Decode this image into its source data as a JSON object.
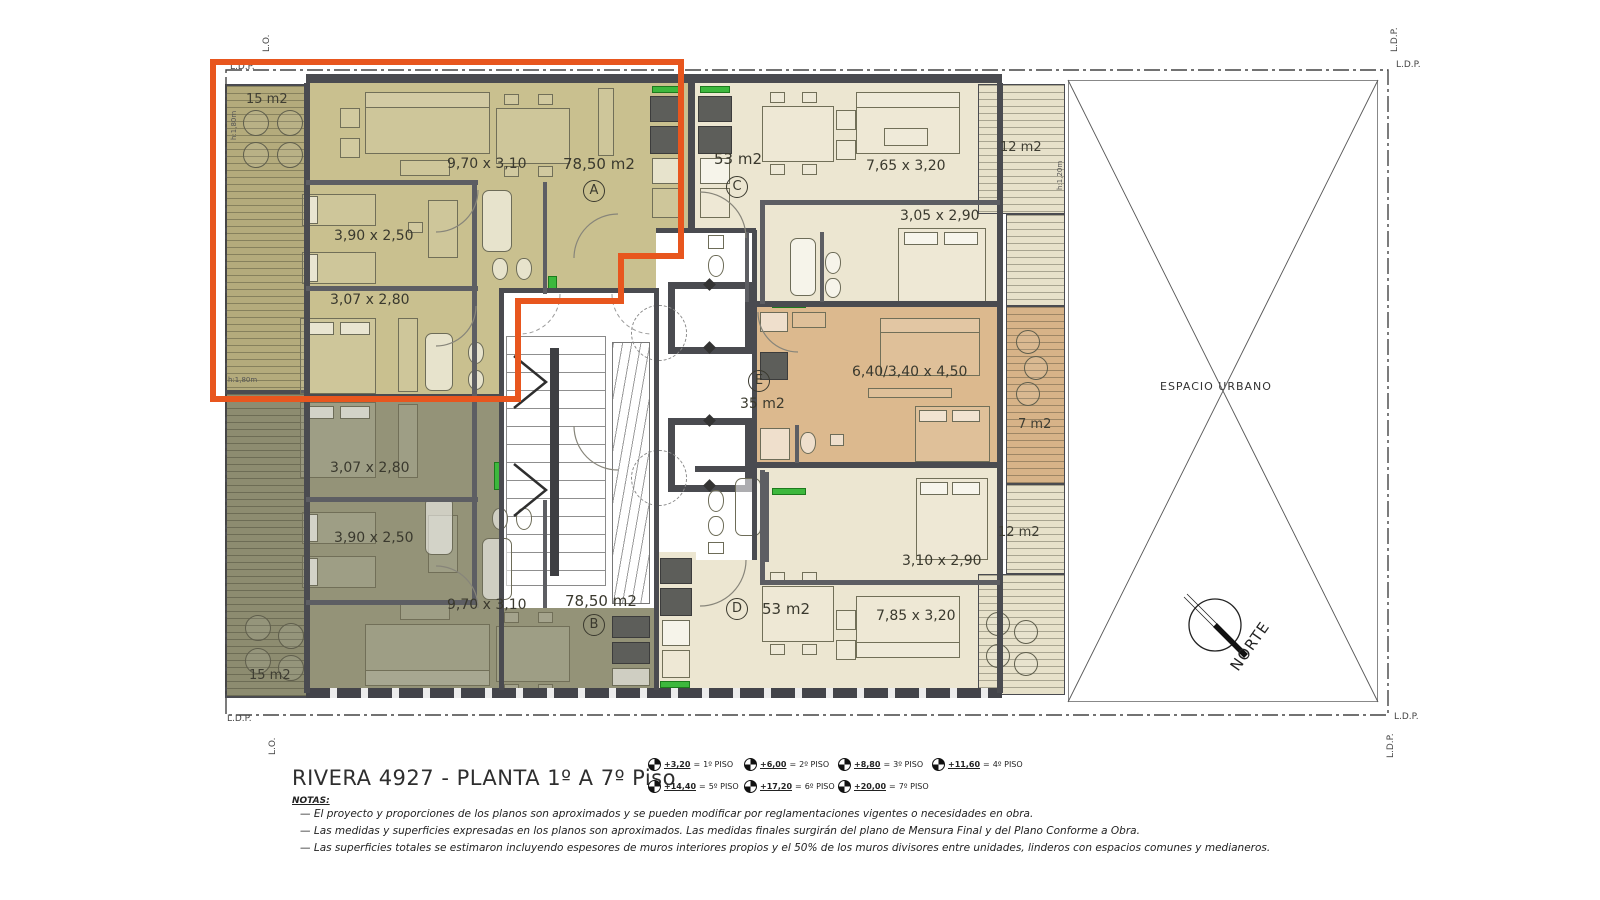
{
  "title_block": {
    "title": "RIVERA 4927  - PLANTA 1º A 7º Piso",
    "notas_label": "NOTAS:",
    "notes": [
      "—   El proyecto y proporciones de los planos son aproximados y se pueden modificar por reglamentaciones vigentes o necesidades en obra.",
      "—   Las medidas y superficies expresadas en los planos son aproximados. Las medidas finales surgirán del plano de Mensura Final y del Plano Conforme a Obra.",
      "—   Las superficies totales se estimaron incluyendo espesores de muros interiores propios y el 50% de los muros divisores entre unidades, linderos con espacios comunes y medianeros."
    ],
    "levels_eq": "=",
    "levels": [
      {
        "value": "+3,20",
        "floor": "1º PISO"
      },
      {
        "value": "+6,00",
        "floor": "2º PISO"
      },
      {
        "value": "+8,80",
        "floor": "3º PISO"
      },
      {
        "value": "+11,60",
        "floor": "4º PISO"
      },
      {
        "value": "+14,40",
        "floor": "5º PISO"
      },
      {
        "value": "+17,20",
        "floor": "6º PISO"
      },
      {
        "value": "+20,00",
        "floor": "7º PISO"
      }
    ]
  },
  "plan": {
    "espacio_urbano": "ESPACIO URBANO",
    "norte": "NORTE",
    "ldp": "L.D.P.",
    "lo": "L.O.",
    "units": {
      "a": {
        "letter": "A",
        "area": "78,50 m2",
        "living": "9,70 x 3,10",
        "bed1": "3,90 x 2,50",
        "bed2": "3,07 x 2,80",
        "balcony": "15 m2"
      },
      "b": {
        "letter": "B",
        "area": "78,50 m2",
        "living": "9,70 x 3,10",
        "bed1": "3,90 x 2,50",
        "bed2": "3,07 x 2,80",
        "balcony": "15 m2"
      },
      "c": {
        "letter": "C",
        "area": "53 m2",
        "living": "7,65 x 3,20",
        "bed": "3,05 x 2,90",
        "balcony": "12 m2"
      },
      "d": {
        "letter": "D",
        "area": "53 m2",
        "living": "7,85 x 3,20",
        "bed": "3,10 x 2,90",
        "balcony": "12 m2"
      },
      "e": {
        "letter": "E",
        "area": "35 m2",
        "dim": "6,40/3,40 x 4,50",
        "balcony": "7 m2"
      }
    },
    "small_labels": {
      "h180": "h:1,80m",
      "h120": "h:1,20m"
    }
  },
  "colors": {
    "highlight_orange": "#E8561E",
    "unit_a_fill": "#C9C08F",
    "unit_b_fill": "#949378",
    "unit_cd_fill": "#ECE6D1",
    "unit_e_fill": "#DCB98E",
    "wall": "#4A4B50",
    "accent_green": "#3DB83D"
  }
}
